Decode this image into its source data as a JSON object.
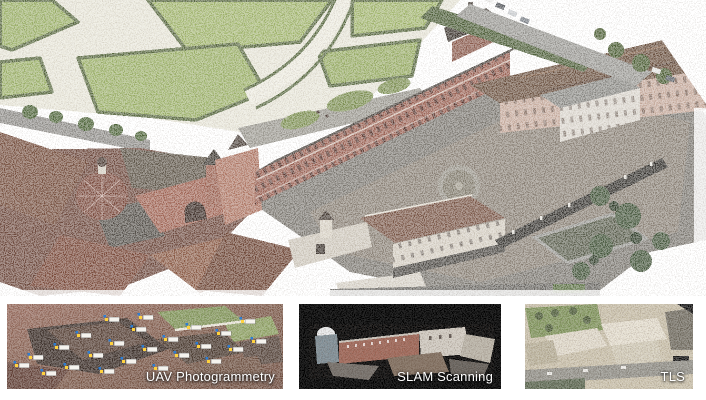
{
  "panels": [
    {
      "id": "uav",
      "label": "UAV Photogrammetry"
    },
    {
      "id": "slam",
      "label": "SLAM Scanning"
    },
    {
      "id": "tls",
      "label": "TLS"
    }
  ],
  "colors": {
    "page_background": "#ffffff",
    "slam_panel_background": "#000000",
    "label_text": "#ffffff",
    "garden_green": "#9cb269",
    "hedge_green": "#57683e",
    "palace_brick": "#9b6254",
    "roof_brown": "#6b5140",
    "courtyard_gray": "#8b8277",
    "marker_yellow": "#ffd23e",
    "marker_blue": "#2d7dd2"
  }
}
